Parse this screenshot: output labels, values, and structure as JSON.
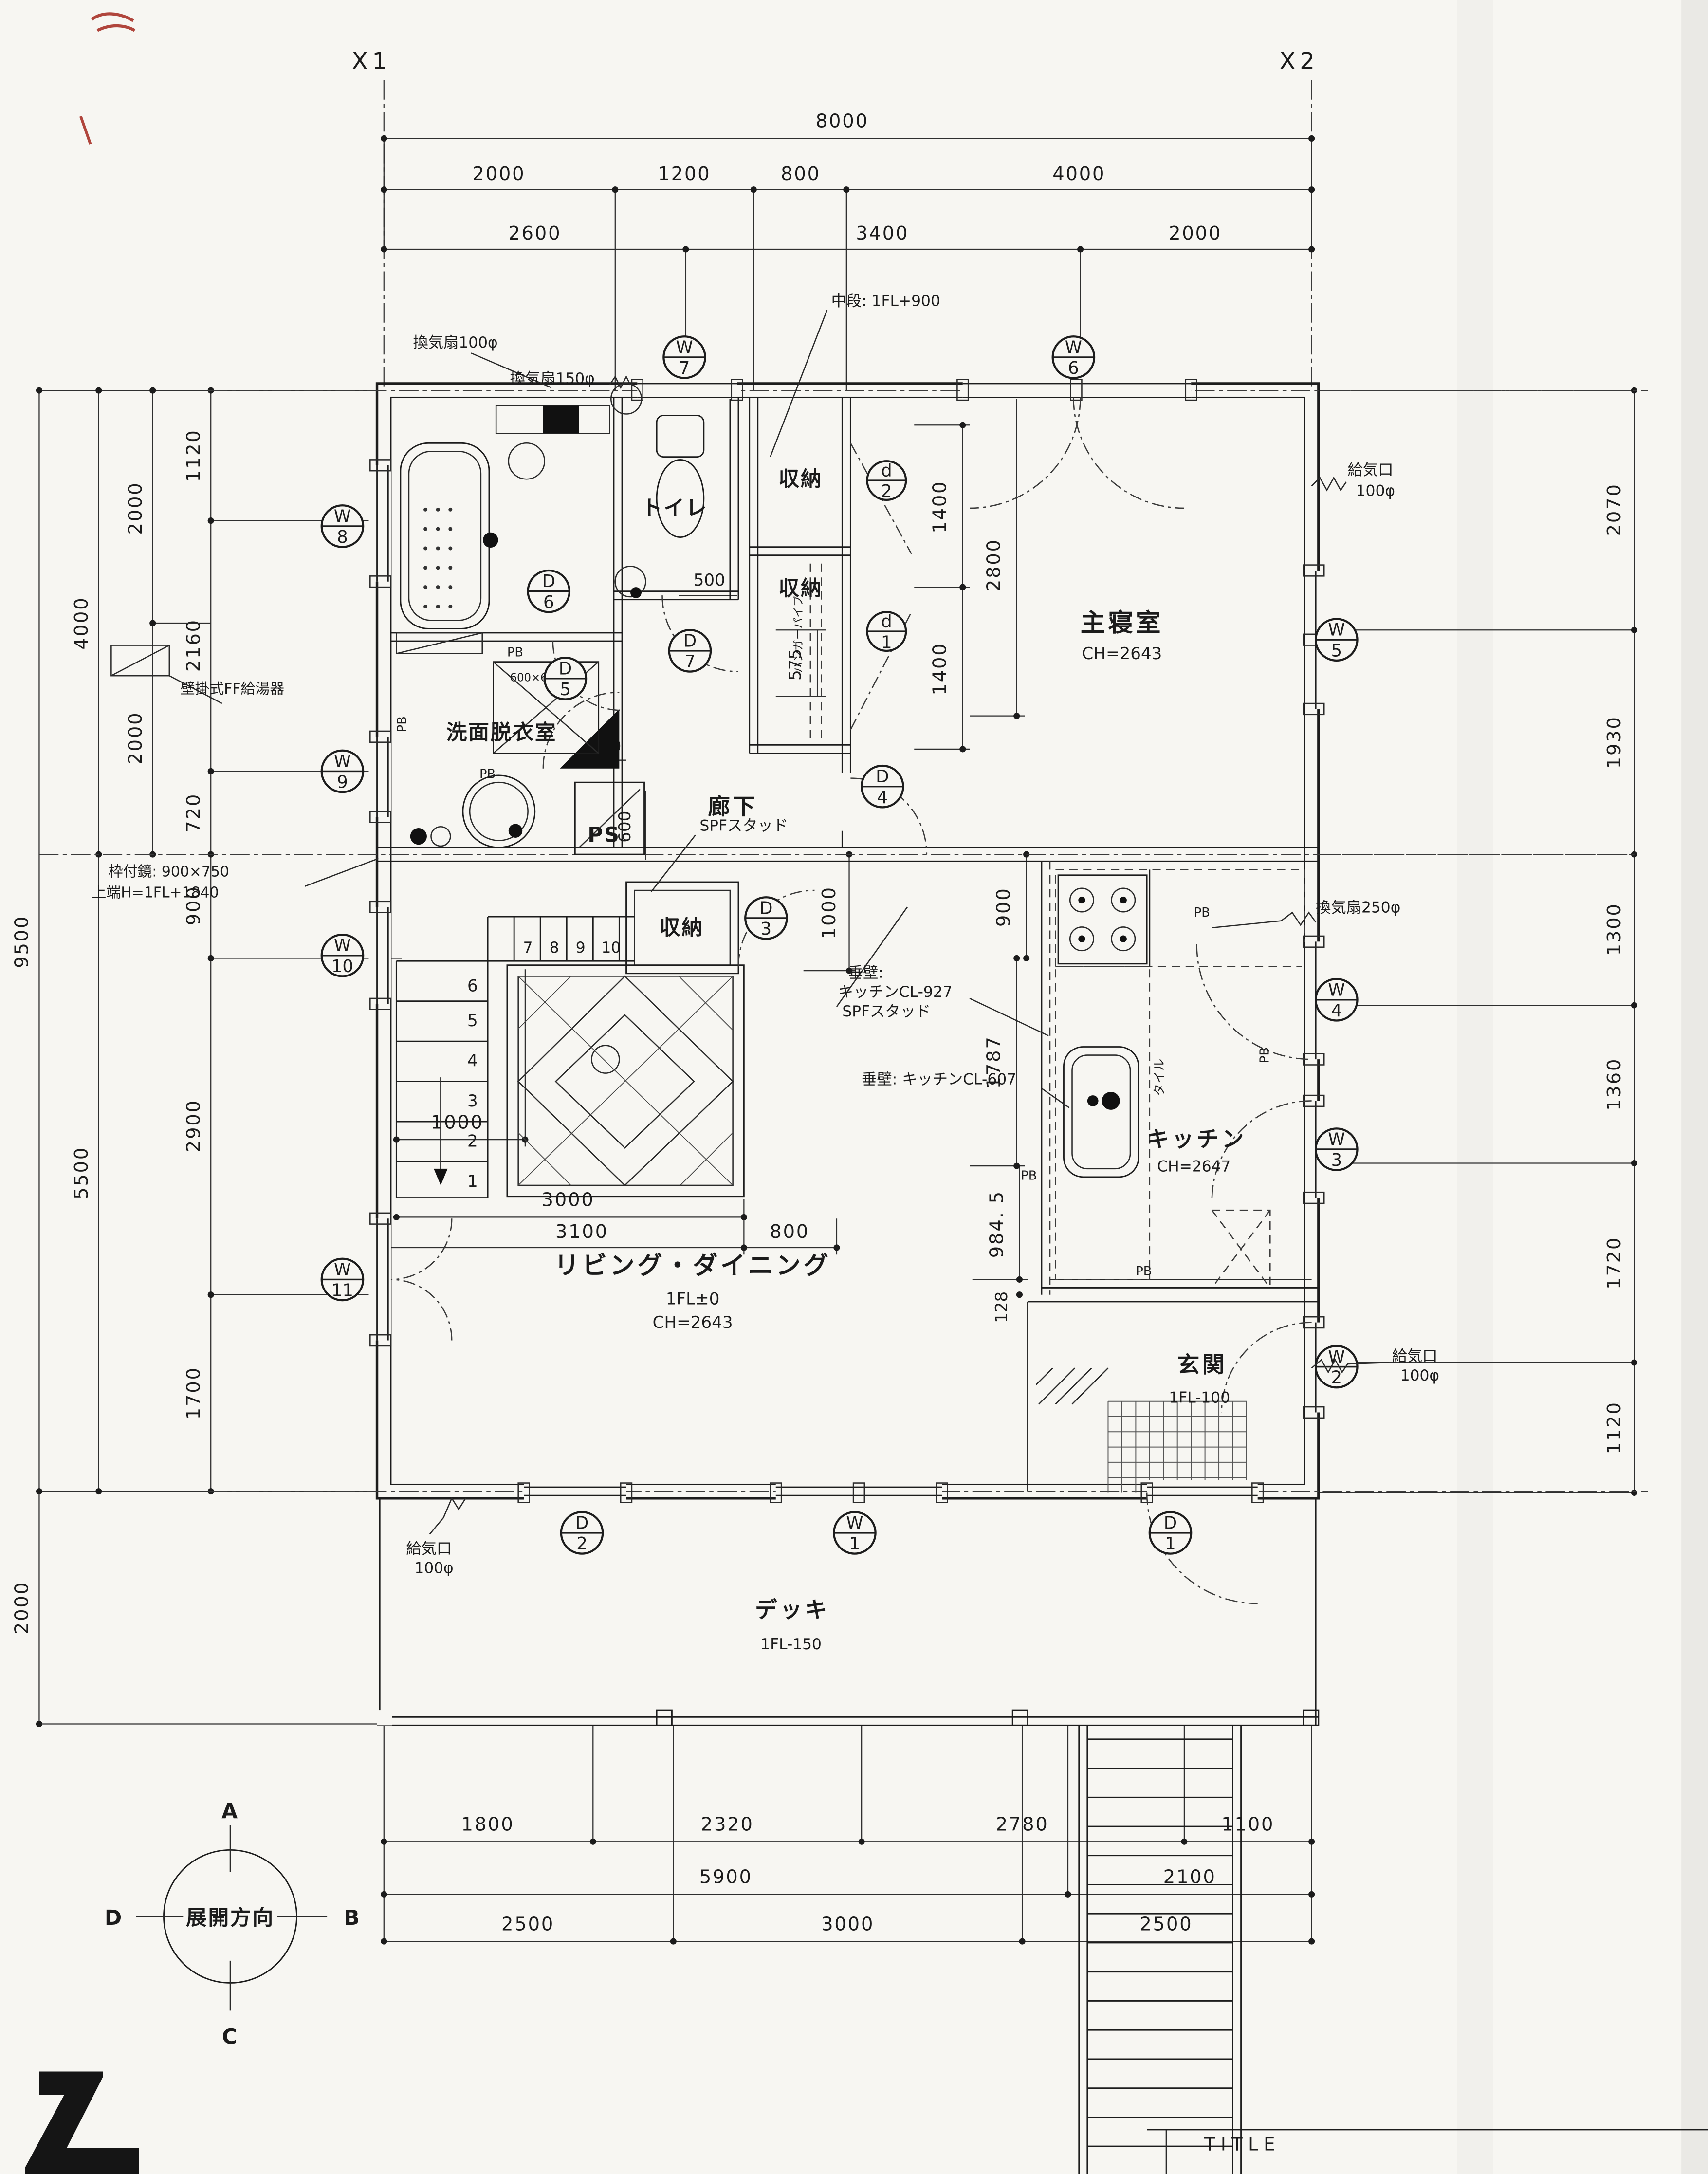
{
  "title": {
    "label": "TITLE"
  },
  "grid": {
    "x1": "X1",
    "x2": "X2"
  },
  "dims": {
    "top": {
      "total": "8000",
      "row2": [
        "2000",
        "1200",
        "800",
        "4000"
      ],
      "row3": [
        "2600",
        "3400",
        "2000"
      ]
    },
    "left": {
      "outer": [
        "9500",
        "2000"
      ],
      "col2": [
        "4000",
        "5500"
      ],
      "col3": [
        "2000",
        "2000"
      ],
      "inner": [
        "1120",
        "2160",
        "720",
        "900",
        "2900",
        "1700"
      ]
    },
    "right": [
      "2070",
      "1930",
      "1300",
      "1360",
      "1720",
      "1120"
    ],
    "bottom": {
      "row1": [
        "1800",
        "2320",
        "2780",
        "1100"
      ],
      "row2": [
        "5900",
        "2100"
      ],
      "row3": [
        "2500",
        "3000",
        "2500"
      ]
    },
    "inner": {
      "closet_a": "1400",
      "closet_b": "1400",
      "bedroom": "2800",
      "toilet": "500",
      "wash_a": "575",
      "wash_b": "380",
      "ps": "600",
      "hall": "1000",
      "kitchen_a": "900",
      "kitchen_b": "1787",
      "kitchen_c": "984. 5",
      "kitchen_d": "128",
      "stair": "1000",
      "living_a": "3000",
      "living_b": "3100",
      "living_c": "800"
    }
  },
  "rooms": {
    "toilet": "トイレ",
    "closet": "収納",
    "master": {
      "name": "主寝室",
      "ch": "CH=2643"
    },
    "wash": "洗面脱衣室",
    "hall": "廊下",
    "ps": "PS",
    "living": {
      "name": "リビング・ダイニング",
      "fl": "1FL±0",
      "ch": "CH=2643"
    },
    "kitchen": {
      "name": "キッチン",
      "ch": "CH=2647"
    },
    "entry": {
      "name": "玄関",
      "fl": "1FL-100"
    },
    "deck": {
      "name": "デッキ",
      "fl": "1FL-150"
    }
  },
  "markers": {
    "w1": {
      "letter": "W",
      "num": "1"
    },
    "w2": {
      "letter": "W",
      "num": "2"
    },
    "w3": {
      "letter": "W",
      "num": "3"
    },
    "w4": {
      "letter": "W",
      "num": "4"
    },
    "w5": {
      "letter": "W",
      "num": "5"
    },
    "w6": {
      "letter": "W",
      "num": "6"
    },
    "w7": {
      "letter": "W",
      "num": "7"
    },
    "w8": {
      "letter": "W",
      "num": "8"
    },
    "w9": {
      "letter": "W",
      "num": "9"
    },
    "w10": {
      "letter": "W",
      "num": "10"
    },
    "w11": {
      "letter": "W",
      "num": "11"
    },
    "d1": {
      "letter": "D",
      "num": "1"
    },
    "d2": {
      "letter": "D",
      "num": "2"
    },
    "d3": {
      "letter": "D",
      "num": "3"
    },
    "d4": {
      "letter": "D",
      "num": "4"
    },
    "d5": {
      "letter": "D",
      "num": "5"
    },
    "d6": {
      "letter": "D",
      "num": "6"
    },
    "d7": {
      "letter": "D",
      "num": "7"
    },
    "sd1": {
      "letter": "d",
      "num": "1"
    },
    "sd2": {
      "letter": "d",
      "num": "2"
    }
  },
  "notes": {
    "vent100": "換気扇100φ",
    "vent150": "換気扇150φ",
    "vent250": "換気扇250φ",
    "midshelf": "中段: 1FL+900",
    "supply": "給気口",
    "phi100": "100φ",
    "heater": "壁掛式FF給湯器",
    "mirror_a": "枠付鏡: 900×750",
    "mirror_b": "上端H=1FL+1840",
    "spf": "SPFスタッド",
    "tare_a": "垂壁:",
    "tare_b": "キッチンCL-927",
    "tare_c": "垂壁: キッチンCL-607",
    "hanger": "ハンガーパイプ",
    "pb": "PB",
    "basin": "600×600",
    "tile": "タイル"
  },
  "stairs": {
    "upper": [
      "7",
      "8",
      "9",
      "10"
    ],
    "lower": [
      "6",
      "5",
      "4",
      "3",
      "2",
      "1"
    ]
  },
  "compass": {
    "label": "展開方向",
    "n": "A",
    "e": "B",
    "s": "C",
    "w": "D"
  }
}
